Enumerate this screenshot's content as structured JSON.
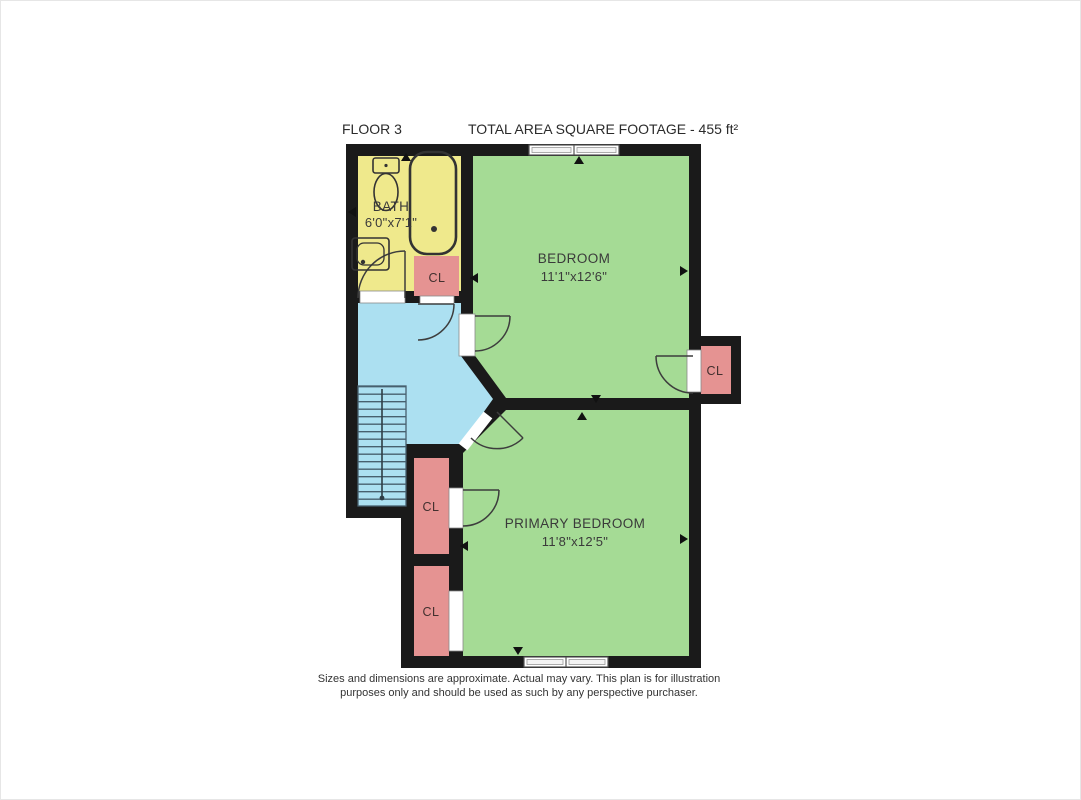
{
  "header": {
    "floor_label": "FLOOR 3",
    "total_area_label": "TOTAL AREA SQUARE FOOTAGE - 455 ft²"
  },
  "rooms": {
    "bath": {
      "name": "BATH",
      "dims": "6'0\"x7'1\""
    },
    "bedroom": {
      "name": "BEDROOM",
      "dims": "11'1\"x12'6\""
    },
    "primary_bedroom": {
      "name": "PRIMARY BEDROOM",
      "dims": "11'8\"x12'5\""
    }
  },
  "closets": {
    "hall": {
      "label": "CL"
    },
    "bedroom": {
      "label": "CL"
    },
    "primary_upper": {
      "label": "CL"
    },
    "primary_lower": {
      "label": "CL"
    }
  },
  "footer": {
    "line1": "Sizes and dimensions are approximate. Actual may vary. This plan is for illustration",
    "line2": "purposes only and should be used as such by any perspective purchaser."
  },
  "colors": {
    "wall": "#1a1a1a",
    "bath_yellow": "#efe98c",
    "room_green": "#a5db95",
    "hall_blue": "#ace0f1",
    "closet_red": "#e59392",
    "window_fill": "#ffffff",
    "stair_tread": "#47606e"
  }
}
